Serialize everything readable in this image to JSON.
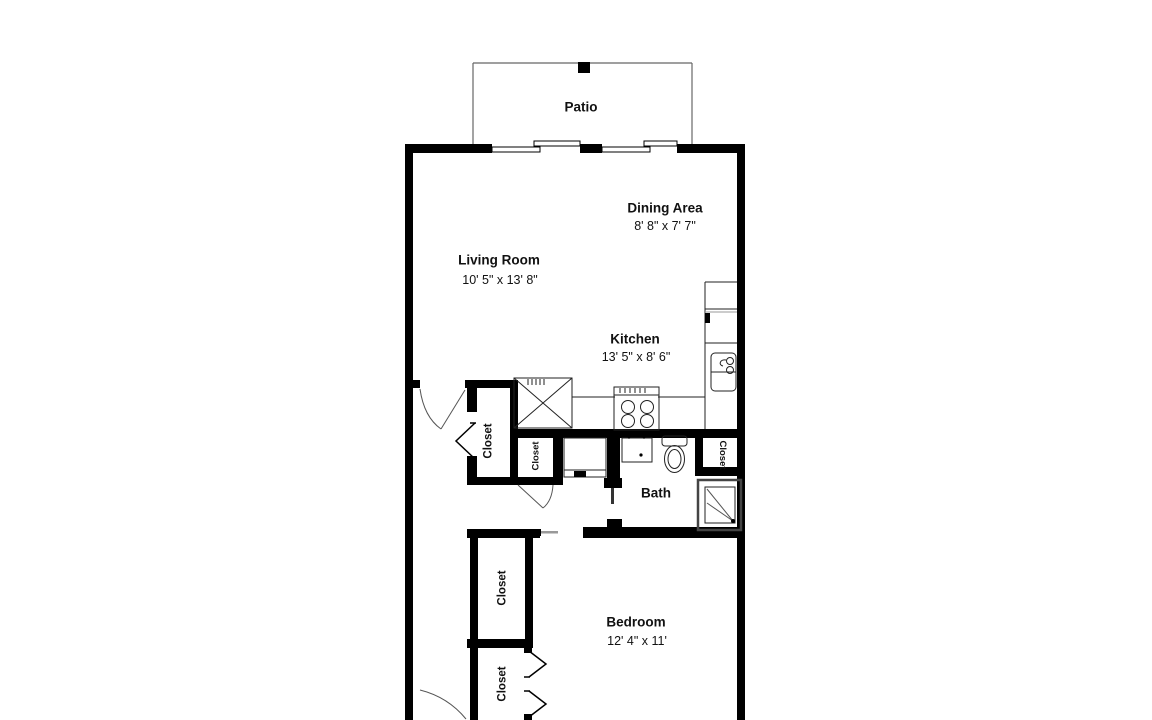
{
  "floorplan": {
    "rooms": {
      "patio": {
        "label": "Patio"
      },
      "dining": {
        "label": "Dining Area",
        "dims": "8' 8\" x 7' 7\""
      },
      "living": {
        "label": "Living Room",
        "dims": "10' 5\" x 13' 8\""
      },
      "kitchen": {
        "label": "Kitchen",
        "dims": "13' 5\" x 8' 6\""
      },
      "bath": {
        "label": "Bath"
      },
      "bedroom": {
        "label": "Bedroom",
        "dims": "12' 4\" x 11'"
      }
    },
    "closets": {
      "entry_closet": {
        "label": "Closet"
      },
      "hall_closet": {
        "label": "Closet"
      },
      "bath_closet": {
        "label": "Closet"
      },
      "bedroom_closet_1": {
        "label": "Closet"
      },
      "bedroom_closet_2": {
        "label": "Closet"
      }
    },
    "colors": {
      "wall": "#000000",
      "line": "#222222",
      "light_line": "#999999",
      "background": "#ffffff"
    }
  }
}
